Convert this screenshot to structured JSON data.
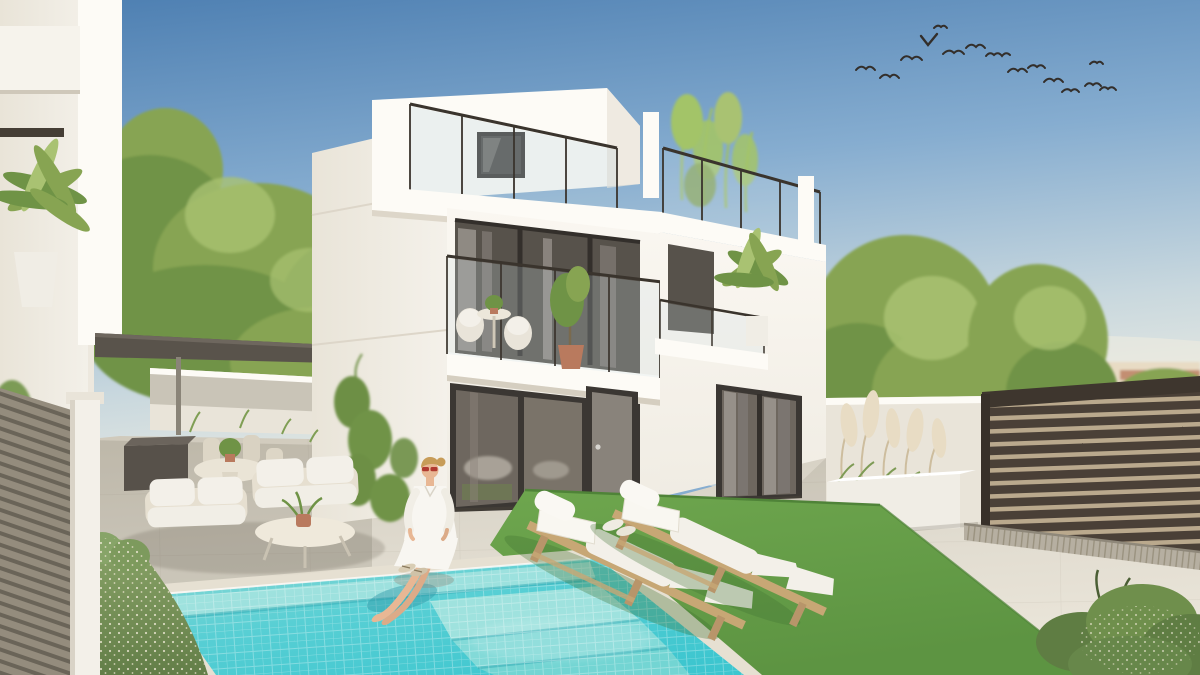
{
  "scene": {
    "description": "Architectural 3D render of a modern three-storey white villa with rooftop terrace and glass railings, a turquoise mosaic-tiled swimming pool with underwater steps, a woman in a white dress sitting on the pool edge with her feet in the water, two wooden sun loungers with white cushions on artificial lawn, a covered lounge corner with outdoor sofas under a dark pergola, a white planter with pampas grass, dark horizontal-slat fencing, green trees, distant terracotta townhouses and a flock of birds in a blue sky.",
    "setting": "sunny residential backyard with pool, daytime",
    "birds_count": 15,
    "loungers_count": 2,
    "people_count": 1,
    "objects": [
      {
        "name": "villa",
        "details": "white modern house, penthouse roof box, roof terrace with glass railing, first-floor balcony with bistro set and potted plants, large dark-framed sliding glass doors"
      },
      {
        "name": "swimming-pool",
        "details": "turquoise mosaic tiles, white grout grid, underwater bench and corner steps, stone coping"
      },
      {
        "name": "woman",
        "details": "blonde hair in bun, red sunglasses, white shirt dress, bare legs in water, sandals beside her"
      },
      {
        "name": "sun-loungers",
        "details": "two light-wood loungers with white cushions and head rolls on green lawn"
      },
      {
        "name": "pergola-lounge",
        "details": "dark flat pergola roof, cream woven sofas with white cushions, oval coffee table, round dining table with chairs, dark storage box"
      },
      {
        "name": "pampas-planter",
        "details": "long white planter with pampas grass plumes and green grasses against low white wall"
      },
      {
        "name": "slat-fence-right",
        "details": "dark brown horizontal slats with drainage strip below"
      },
      {
        "name": "slat-fence-left",
        "details": "grey-taupe horizontal slats with white pillar"
      },
      {
        "name": "flowering-hedge",
        "details": "green hedge with tiny white blossoms beside the pool"
      },
      {
        "name": "background-town",
        "details": "cream and terracotta Mediterranean townhouses behind trees"
      },
      {
        "name": "trees",
        "details": "round green canopies behind the garden walls, bamboo on the roof terrace, palms on balconies"
      },
      {
        "name": "birds",
        "details": "flock flying in upper right sky"
      }
    ]
  },
  "palette": {
    "sky_top": "#4c7eb1",
    "sky_mid": "#86add0",
    "sky_low": "#c9d8de",
    "sky_horizon": "#e7e9e2",
    "white_wall": "#f6f3ec",
    "white_bright": "#fdfbf6",
    "white_shade": "#e9e4d9",
    "side_wall": "#efebe2",
    "glass_dark": "#57524b",
    "glass_frame": "#3b3733",
    "glass_panel": "#6e675f",
    "curtain_light": "#969089",
    "curtain_dark": "#7b7570",
    "railing": "#3a342d",
    "pergola": "#59534b",
    "tree_green": "#87a452",
    "tree_dark": "#6f9346",
    "tree_light": "#a9c272",
    "bamboo": "#a3c468",
    "ivy": "#6d8f45",
    "pool_shallow": "#8ed8d4",
    "pool_mid": "#58cfd4",
    "pool_deep": "#3dc6cf",
    "pool_step": "#a7e4df",
    "grout": "#ffffff",
    "coping": "#e6e0d2",
    "paving": "#ddd8cc",
    "paving_dark": "#cfc9bb",
    "paving_light": "#eae5d9",
    "lawn": "#6ea64e",
    "lawn_dark": "#4f8338",
    "wood": "#c7a775",
    "wood_dark": "#b8956a",
    "cushion": "#f3f0e9",
    "fence_dark": "#4a4037",
    "fence_gap": "#baa98d",
    "fence_gray": "#948c7d",
    "fence_gray_gap": "#6a6458",
    "planter": "#f0ede5",
    "pampas": "#e8dcc4",
    "hedge": "#7d9a5d",
    "hedge_dark": "#637e48",
    "flower": "#f2ecd9",
    "town_cream": "#e8dbc4",
    "town_roof": "#dcc9ab",
    "town_terra": "#b97a5e",
    "skin": "#e8b794",
    "dress": "#f8f6f1",
    "hair": "#c79c58",
    "glasses_red": "#b03a30",
    "bird": "#332e2a",
    "shadow": "#57503f",
    "drain": "#b6afa1",
    "box_dark": "#57514a"
  }
}
